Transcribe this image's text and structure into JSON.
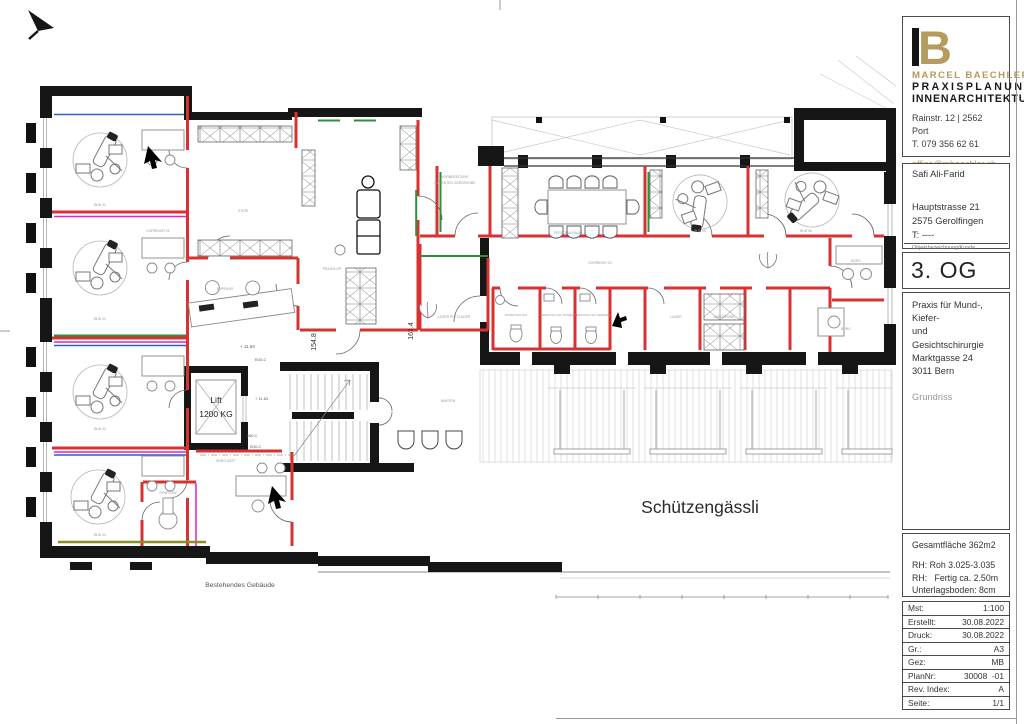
{
  "title_block": {
    "logo": {
      "b": "B",
      "brand": "MARCEL BAECHLER",
      "line1": "PRAXISPLANUNG",
      "line2": "INNENARCHITEKTUR"
    },
    "contact": {
      "address": "Rainstr. 12 | 2562 Port",
      "phone": "T. 079 356 62 61",
      "email": "office@mbaechler.ch",
      "web": "marcelbaechler.ch"
    },
    "client": {
      "name": "Safi Ali-Farid",
      "street": "Hauptstrasse 21",
      "city": "2575 Gerolfingen",
      "phone": "T: ----",
      "caption": "Objektbezeichnung/Kunde"
    },
    "floor": "3. OG",
    "project": {
      "line1": "Praxis für Mund-, Kiefer-",
      "line2": "und Gesichtschirurgie",
      "line3": "Marktgasse 24",
      "line4": "3011 Bern",
      "drawing_type": "Grundriss"
    },
    "area": {
      "total": "Gesamtfläche 362m2",
      "rh1": "RH: Roh 3.025-3.035",
      "rh2": "RH:   Fertig ca. 2.50m",
      "floor_build": "Unterlagsboden: 8cm"
    },
    "table": {
      "rows": [
        {
          "label": "Mst:",
          "value": "1:100"
        },
        {
          "label": "Erstellt:",
          "value": "30.08.2022"
        },
        {
          "label": "Druck:",
          "value": "30.08.2022"
        },
        {
          "label": "Gr.:",
          "value": "A3"
        },
        {
          "label": "Gez:",
          "value": "MB"
        },
        {
          "label": "PlanNr:",
          "value": "30008  -01"
        },
        {
          "label": "Rev. Index:",
          "value": "A"
        },
        {
          "label": "Seite:",
          "value": "1/1"
        }
      ]
    }
  },
  "plan": {
    "street": "Schützengässli",
    "existing": "Bestehendes Gebäude",
    "lift": {
      "line1": "Lift",
      "line2": "1200 KG"
    },
    "levels": [
      "+ 11.63",
      "+ 11.63"
    ],
    "dims": [
      "154.8",
      "161.4"
    ],
    "fire_ratings": [
      "EI30-C",
      "EI30-C",
      "E60-C"
    ],
    "room_labels": [
      "BHD 01",
      "BHD 02",
      "BHD 03",
      "BHD 04",
      "KORRIDOR 01",
      "STERI",
      "EMPFANG",
      "PRAXIS-OP",
      "VORBEREITUNG",
      "PATIENTEN GARDEROBE",
      "LAGER PUTZLAGER",
      "PERSONALRAUM",
      "KORRIDOR 03",
      "BHD 05",
      "BHD 06",
      "PATIENTEN WC",
      "PERSONAL WC DAMEN",
      "PERSONAL WC HERREN",
      "LAGER",
      "GARDEROBE",
      "BÜRO",
      "BÜRO",
      "WARTEN",
      "RÖNTGEN",
      "BÜRO ARZT"
    ],
    "colors": {
      "wall": "#161616",
      "new_wall": "#d63232",
      "magenta": "#e020d0",
      "blue": "#2b62c4",
      "green": "#2f8f3c",
      "olive": "#8f8f20",
      "gold": "#b49b5e"
    }
  }
}
